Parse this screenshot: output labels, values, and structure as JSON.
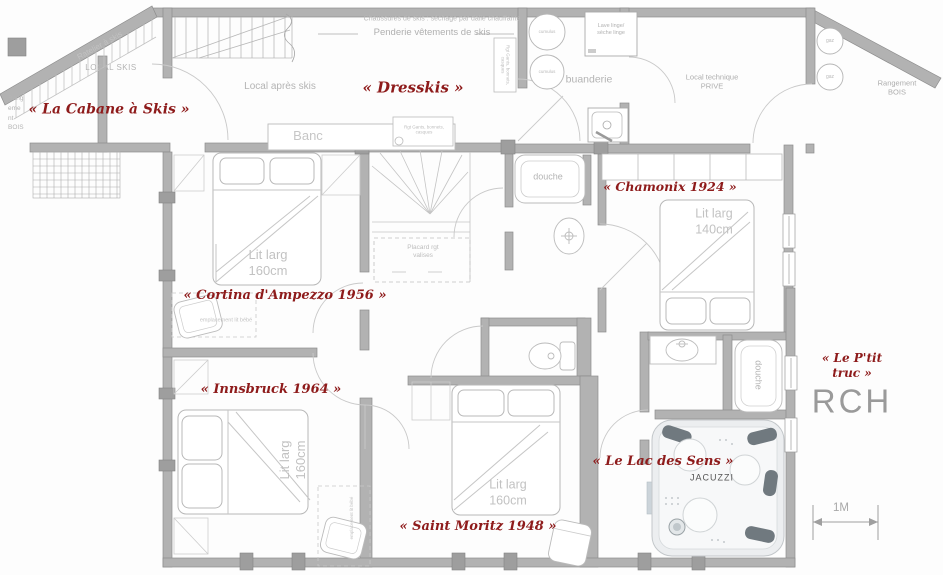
{
  "floor": {
    "code": "RCH",
    "scale_label": "1M"
  },
  "colors": {
    "accent_red": "#8e1b1b",
    "wall_gray": "#b2b2b2",
    "label_gray": "#b4b4b4"
  },
  "rooms": {
    "cabane": "« La Cabane à Skis »",
    "dresskis": "« Dresskis »",
    "chamonix": "« Chamonix 1924 »",
    "cortina": "« Cortina d'Ampezzo 1956 »",
    "innsbruck": "« Innsbruck 1964 »",
    "saint_moritz": "« Saint Moritz 1948 »",
    "lac_des_sens": "« Le Lac des Sens »",
    "ptit_truc": "« Le P'tit truc »"
  },
  "areas": {
    "ratelier": "Ratelier à skis",
    "local_skis": "LOCAL SKIS",
    "rangement_bois_left": "Rang\neme\nnt\nBOIS",
    "local_apres_skis": "Local après skis",
    "chaussures": "Chaussures de skis : séchage par dalle chauffante",
    "penderie": "Penderie vêtements de skis",
    "banc": "Banc",
    "rgt_gants": "Rgt Gants, bonnets, casques",
    "cumulus": "cumulus",
    "lave_linge": "Lave linge/\nsèche linge",
    "buanderie": "buanderie",
    "local_technique": "Local technique\nPRIVE",
    "gaz": "gaz",
    "rangement_bois_right": "Rangement\nBOIS",
    "douche": "douche",
    "placard": "Placard rgt\nvalises",
    "lit_160": "Lit larg\n160cm",
    "lit_140": "Lit larg\n140cm",
    "lit_bebe": "emplacement lit bébé",
    "jacuzzi": "JACUZZI"
  }
}
